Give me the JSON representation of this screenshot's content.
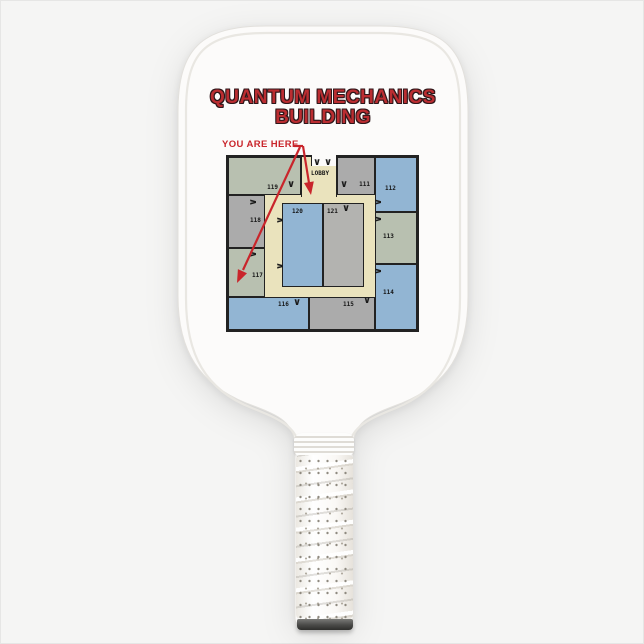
{
  "theme": {
    "page_bg": "#f5f5f4",
    "paddle_face": "#fcfbfa",
    "title_red": "#bb2d31",
    "title_outline": "#2e171a",
    "arrow_red": "#c9252b",
    "wall": "#222222",
    "hall_cream": "#eae3bd",
    "room_blue": "#92b5d3",
    "room_gray": "#ababab",
    "room_green": "#b8c0b0",
    "room_inner_gray": "#b3b3b0",
    "grip_white": "#faf8f5",
    "cap_dark": "#4a4a48"
  },
  "paddle": {
    "title_line1": "QUANTUM MECHANICS",
    "title_line2": "BUILDING"
  },
  "map": {
    "you_are_here_label": "YOU ARE HERE",
    "lobby_label": "LOBBY",
    "door_glyph": "∨",
    "rooms": [
      {
        "id": "119",
        "label": "119",
        "color": "room_green"
      },
      {
        "id": "111",
        "label": "111",
        "color": "room_gray"
      },
      {
        "id": "112",
        "label": "112",
        "color": "room_blue"
      },
      {
        "id": "113",
        "label": "113",
        "color": "room_green"
      },
      {
        "id": "114",
        "label": "114",
        "color": "room_blue"
      },
      {
        "id": "115",
        "label": "115",
        "color": "room_gray"
      },
      {
        "id": "116",
        "label": "116",
        "color": "room_blue"
      },
      {
        "id": "117",
        "label": "117",
        "color": "room_green"
      },
      {
        "id": "118",
        "label": "118",
        "color": "room_gray"
      },
      {
        "id": "120",
        "label": "120",
        "color": "room_blue"
      },
      {
        "id": "121",
        "label": "121",
        "color": "room_inner_gray"
      }
    ]
  }
}
